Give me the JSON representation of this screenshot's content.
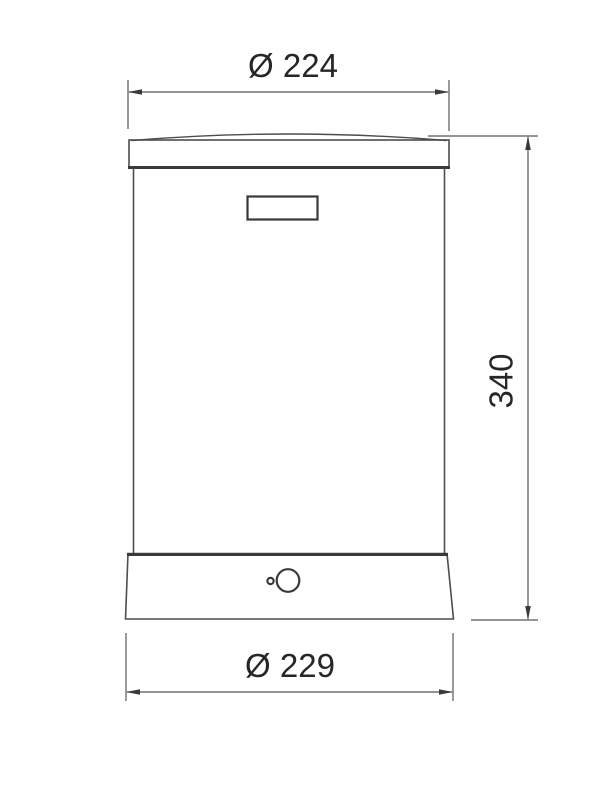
{
  "drawing_type": "technical-dimension-drawing",
  "dimensions": {
    "top_diameter": "Ø 224",
    "height": "340",
    "bottom_diameter": "Ø 229"
  },
  "colors": {
    "background": "#ffffff",
    "outline": "#4d4d4b",
    "outline_heavy": "#3a3a38",
    "dimension_line": "#565654",
    "text": "#262624"
  }
}
